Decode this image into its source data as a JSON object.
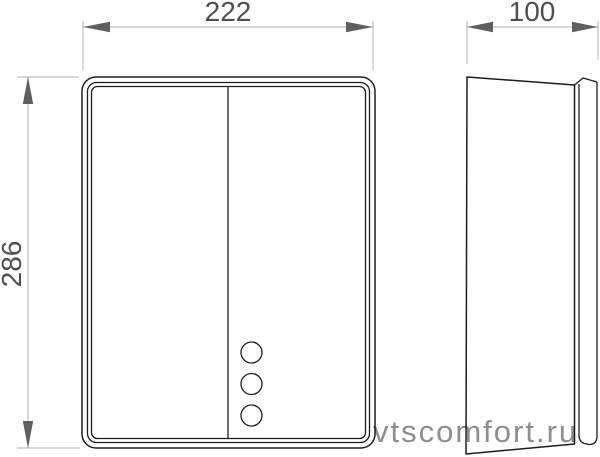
{
  "colors": {
    "background": "#ffffff",
    "drawing_line": "#1d1d1d",
    "dim_line": "#b0b0b0",
    "dim_arrow": "#5f5f5f",
    "dim_text": "#4f4f4f",
    "watermark": "#8e8e8e"
  },
  "dimensions": {
    "width": {
      "label": "222"
    },
    "depth": {
      "label": "100"
    },
    "height": {
      "label": "286"
    }
  },
  "watermark": {
    "text": "vtscomfort.ru"
  }
}
